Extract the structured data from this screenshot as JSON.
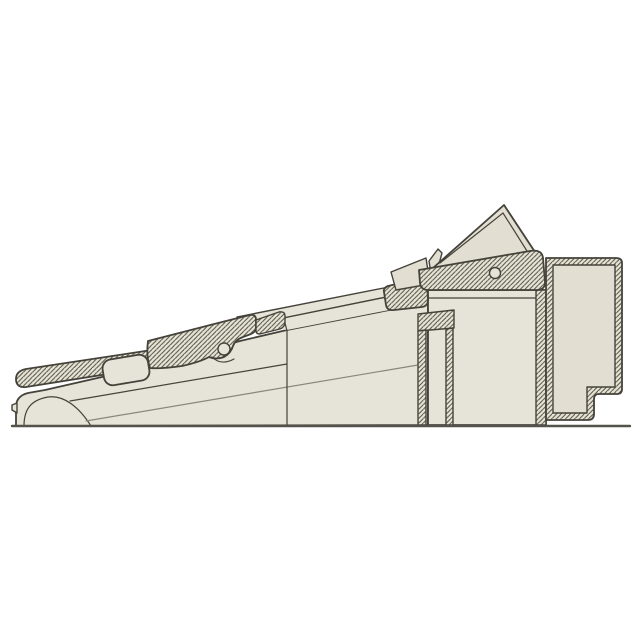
{
  "canvas": {
    "width": 640,
    "height": 640,
    "background": "#ffffff"
  },
  "colors": {
    "beige": "#e6e3d8",
    "beige2": "#e2dfd2",
    "hatch": "#56523f",
    "line": "#44423a",
    "soft": "#8a8779",
    "ground": "#53524b",
    "bg": "#ffffff"
  },
  "figure": {
    "kind": "technical cross-section line drawing",
    "text_labels": [],
    "parts": [
      "ground-line",
      "lower-shell-nose",
      "wedge-body",
      "clamp-strip-section",
      "strip-slot",
      "mid-web-section",
      "pivot-hole-small",
      "thin-plate",
      "latch-section",
      "rear-wedge-panel",
      "top-rail-section",
      "rail-hole",
      "center-block",
      "slot-channel",
      "rear-block"
    ]
  }
}
